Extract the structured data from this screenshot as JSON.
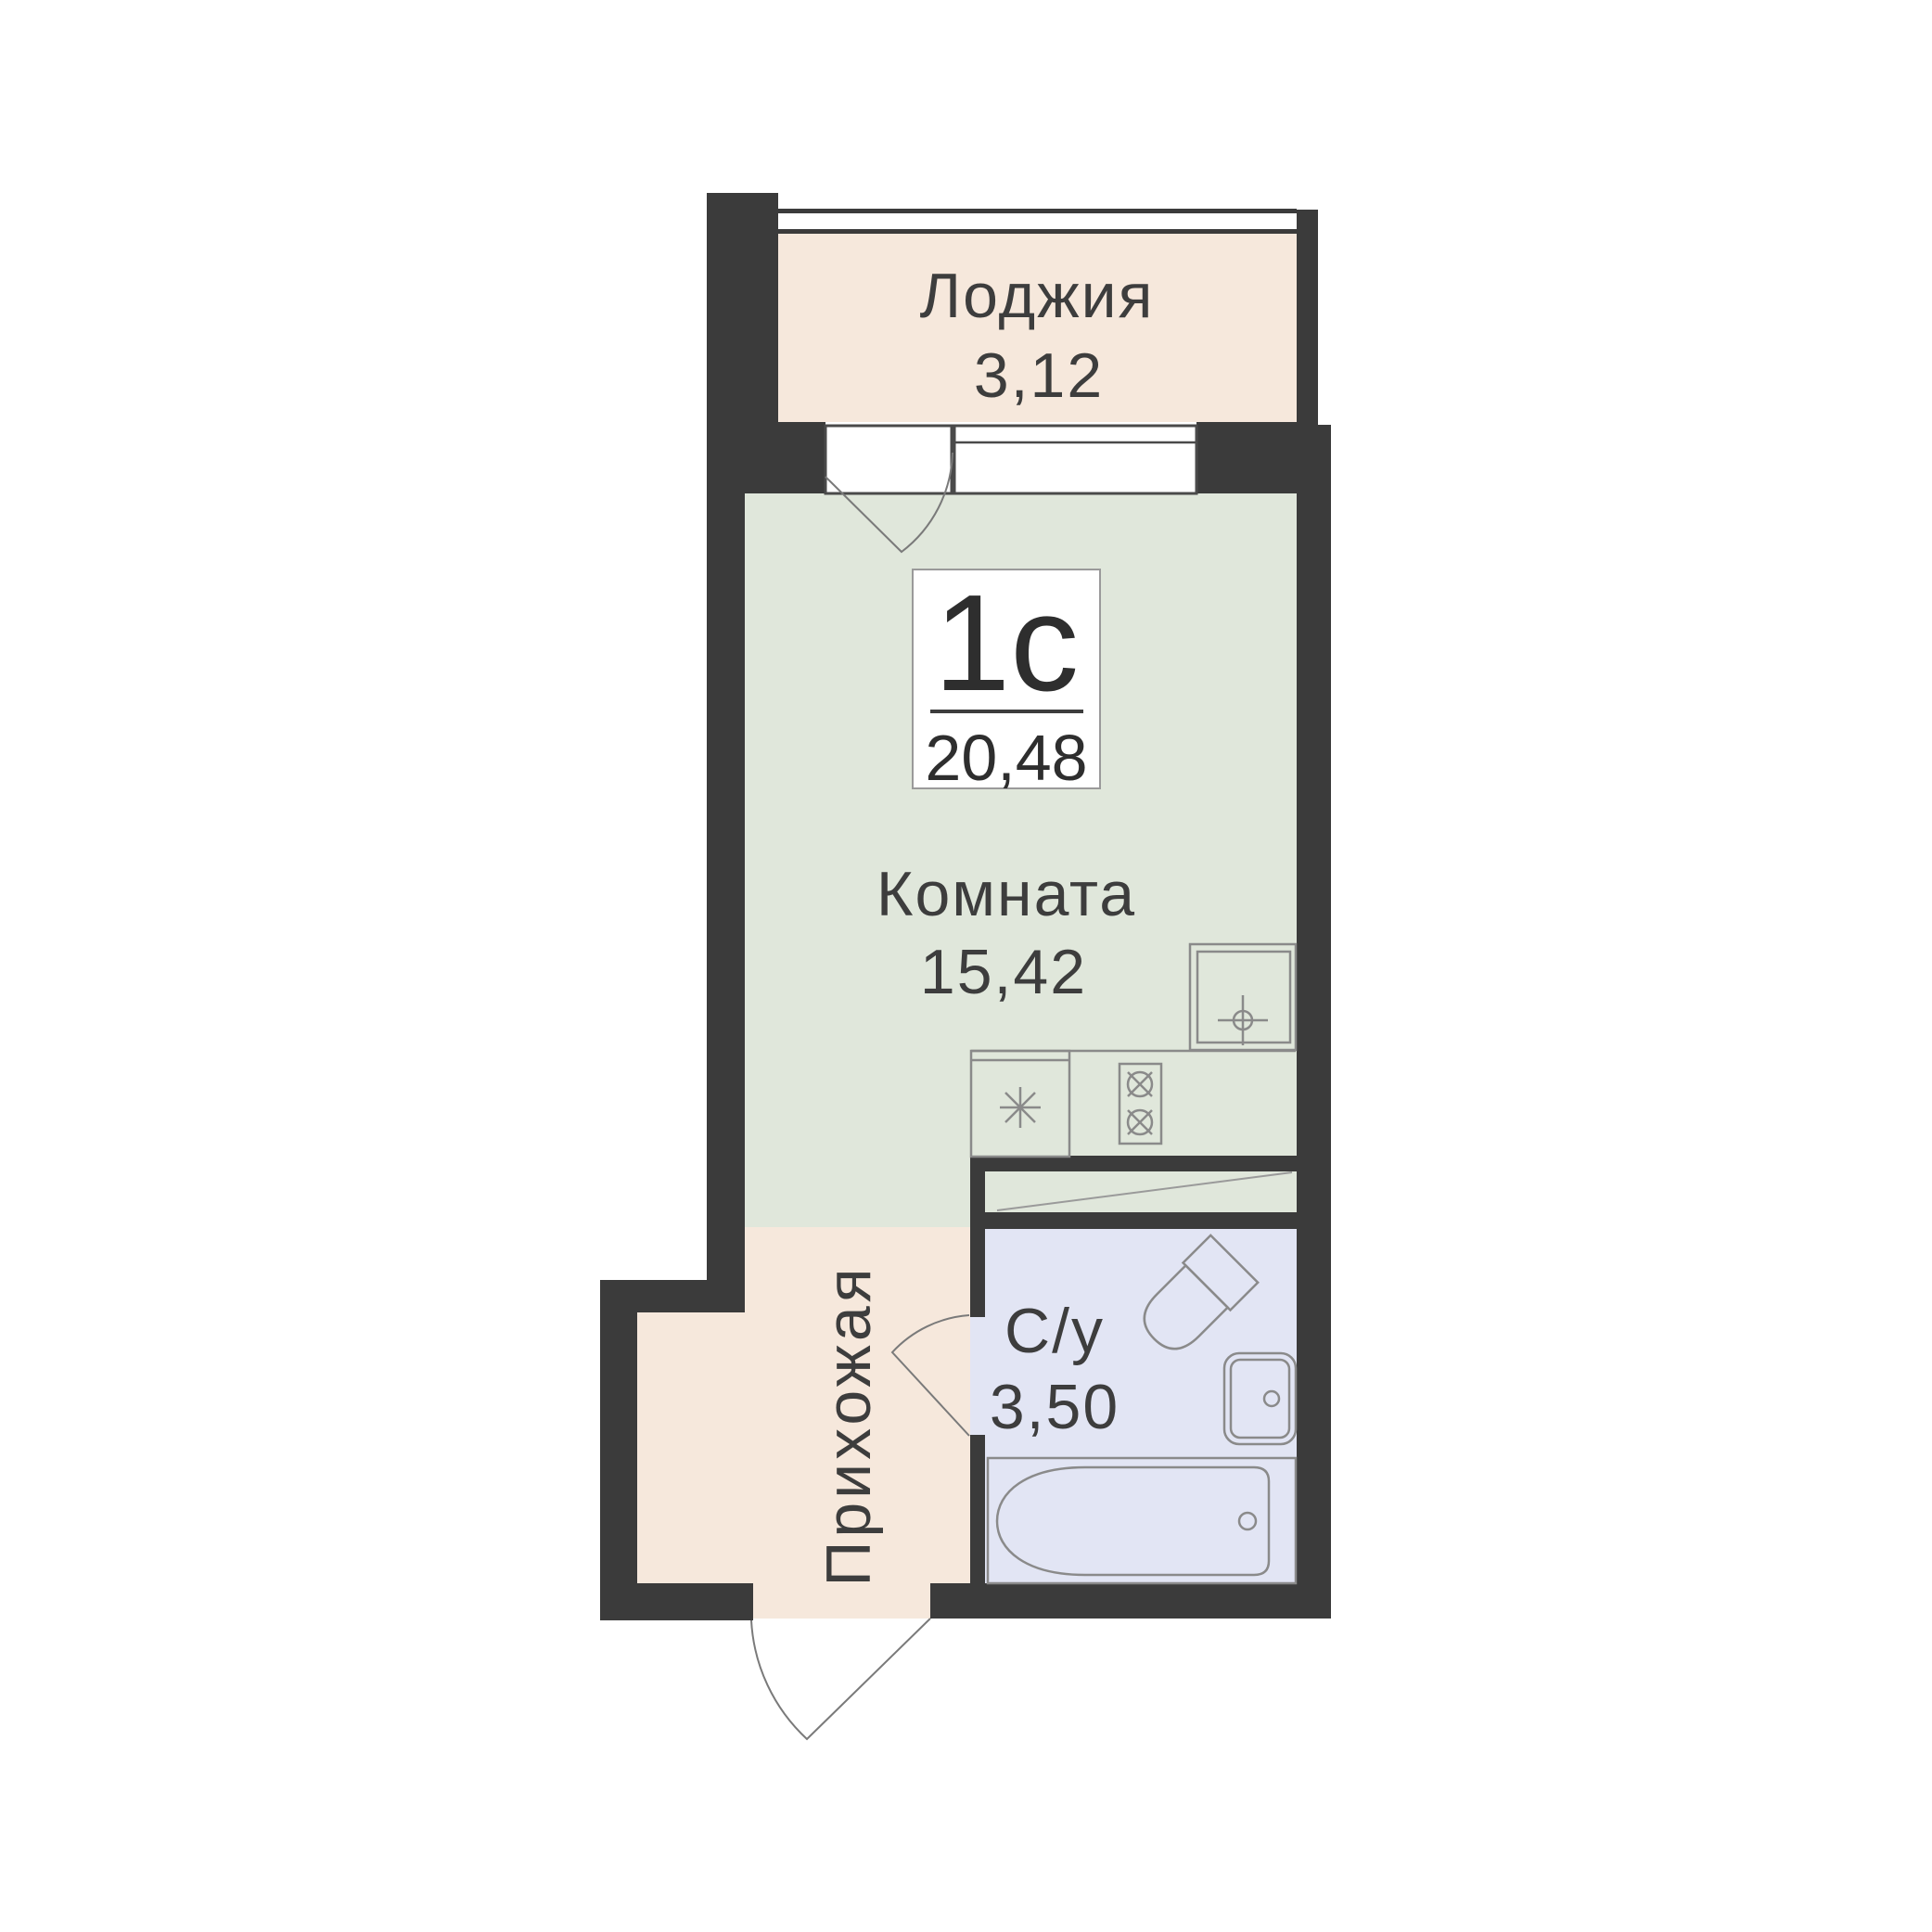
{
  "unit": {
    "type_label": "1с",
    "total_area": "20,48"
  },
  "rooms": {
    "loggia": {
      "label": "Лоджия",
      "area": "3,12"
    },
    "living": {
      "label": "Комната",
      "area": "15,42"
    },
    "hallway": {
      "label": "Прихожая"
    },
    "bathroom": {
      "label": "С/у",
      "area": "3,50"
    }
  },
  "fixtures": [
    "kitchen-sink-icon",
    "refrigerator-icon",
    "stove-icon",
    "toilet-icon",
    "bathroom-sink-icon",
    "bathtub-icon"
  ],
  "colors": {
    "wall": "#3b3b3b",
    "loggia_fill": "#f6e8dc",
    "hallway_fill": "#f6e8dc",
    "room_fill": "#e0e7db",
    "bathroom_fill": "#e2e5f4",
    "text": "#3d3d3d",
    "fixture_stroke": "#8a8a8a",
    "badge_border": "#9a9a9a",
    "badge_fill": "#ffffff"
  }
}
